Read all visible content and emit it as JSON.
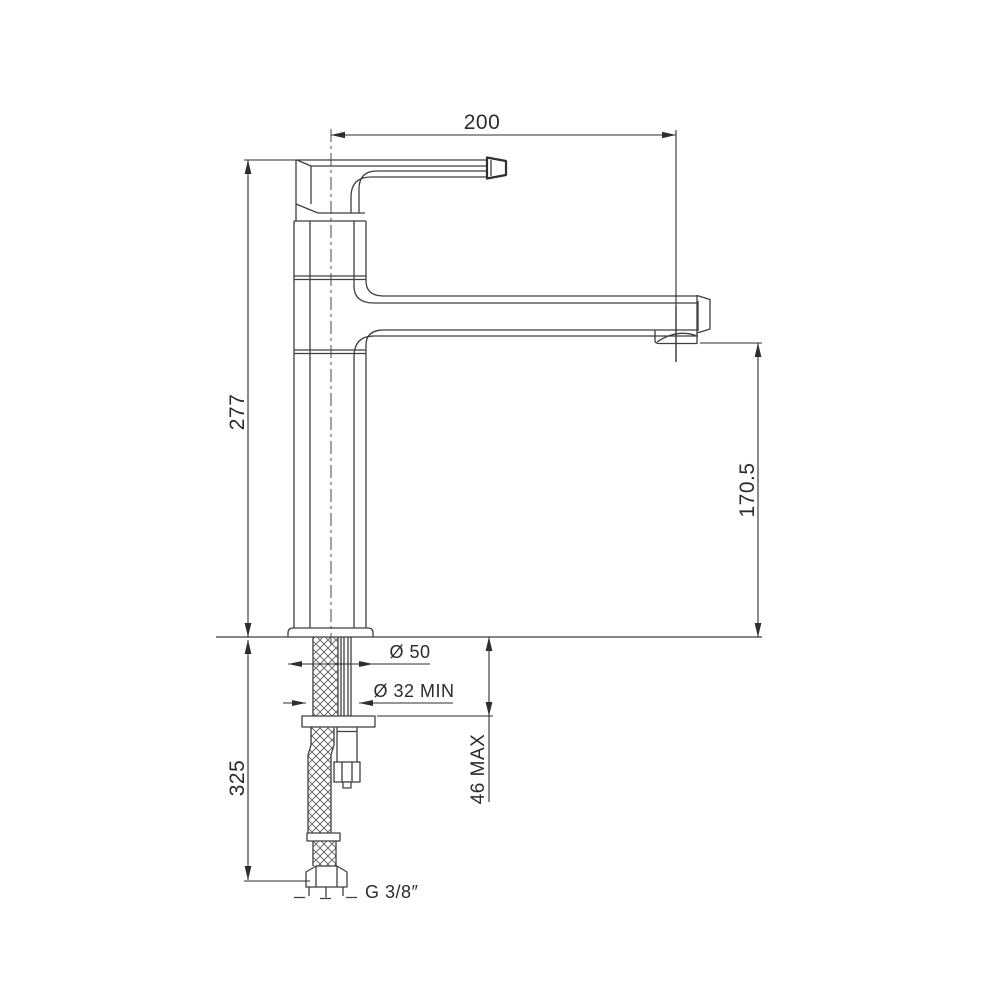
{
  "drawing": {
    "subject": "single-lever basin mixer tap — dimensioned side elevation",
    "background": "#ffffff",
    "line_color": "#3f3f3f",
    "text_color": "#2b2b2b",
    "labels": {
      "spout_reach": "200",
      "height_above_deck": "277",
      "spout_outlet_height": "170.5",
      "base_diameter": "Ø 50",
      "min_hole_diameter": "Ø 32 MIN",
      "max_counter_thickness": "46 MAX",
      "below_deck_length": "325",
      "hose_thread": "G 3/8″"
    }
  }
}
